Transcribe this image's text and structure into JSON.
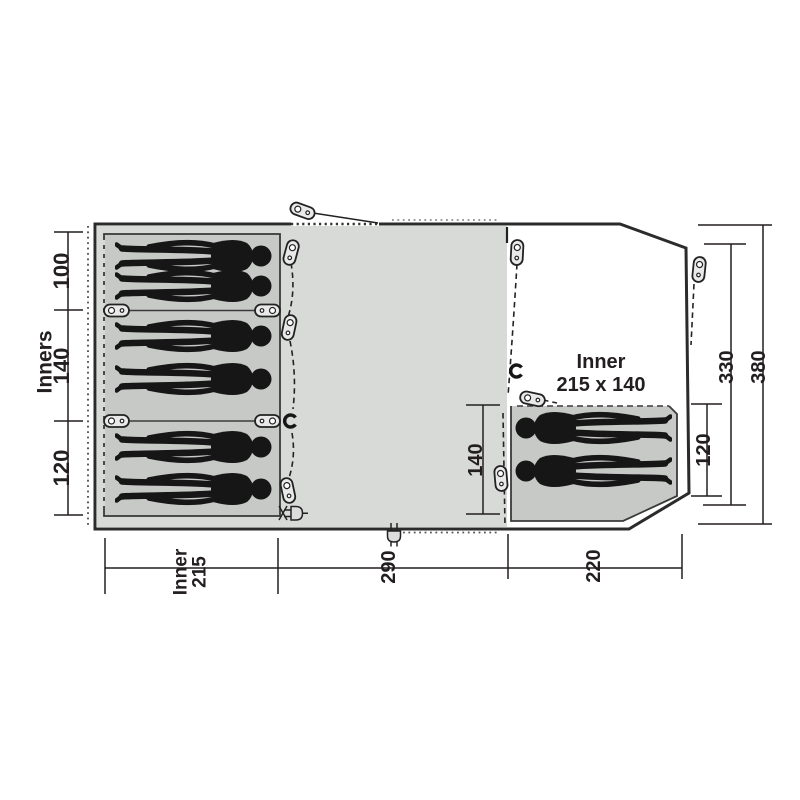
{
  "floorplan": {
    "inner_right_label": {
      "line1": "Inner",
      "line2": "215 x 140"
    },
    "dimensions": {
      "left_axis_label": "Inners",
      "left_sections": [
        "100",
        "140",
        "120"
      ],
      "middle_vertical": "140",
      "right_inner_vertical": "120",
      "right_outer_330": "330",
      "right_outer_380": "380",
      "bottom_left_inner": {
        "line1": "Inner",
        "line2": "215"
      },
      "bottom_middle": "290",
      "bottom_right": "220"
    },
    "people": {
      "left_inner_count": 6,
      "right_inner_count": 2
    },
    "colors": {
      "background": "#ffffff",
      "living_area": "#d8dad8",
      "inner_area": "#c7c9c7",
      "outline": "#2b2b2b",
      "dimension_lines": "#231f20",
      "silhouette": "#161616",
      "peg_fill": "#e8e9e8"
    },
    "icons": [
      "tent-peg-icon",
      "hook-clip-icon",
      "power-plug-icon",
      "guy-line",
      "door-dashed-line"
    ]
  }
}
